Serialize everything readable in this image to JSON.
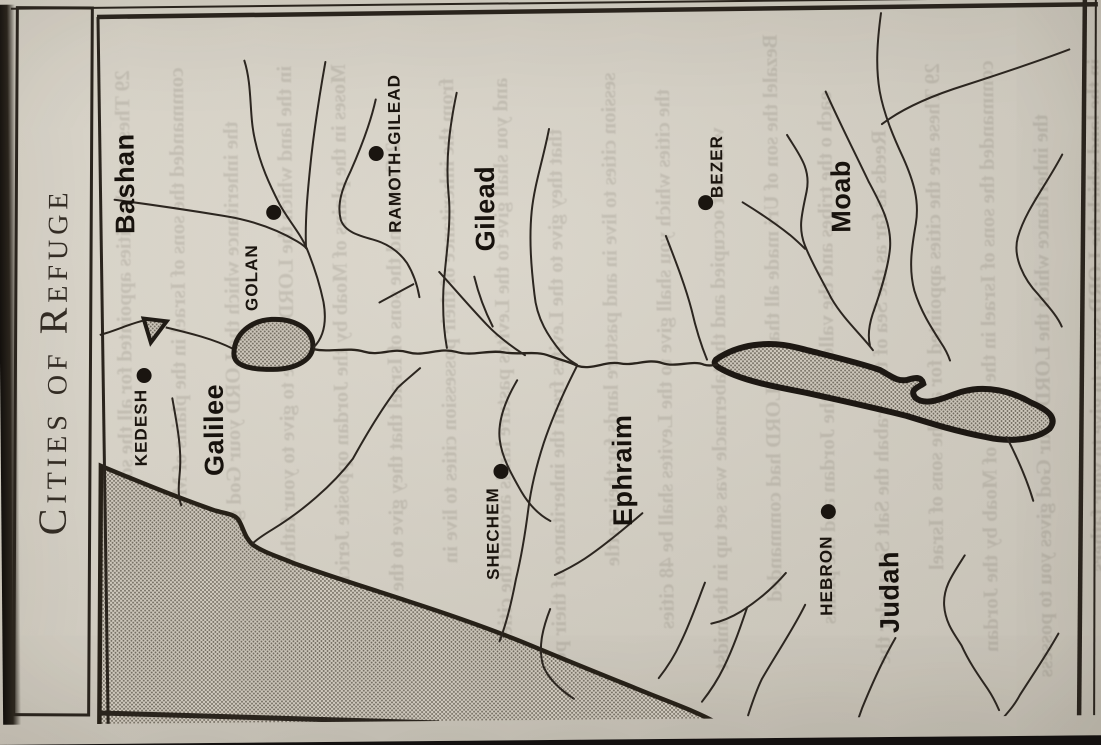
{
  "page": {
    "title": "Cities of Refuge"
  },
  "map": {
    "regions": [
      "Bashan",
      "Galilee",
      "Gilead",
      "Ephraim",
      "Moab",
      "Judah"
    ],
    "cities": [
      "KEDESH",
      "GOLAN",
      "RAMOTH-GILEAD",
      "SHECHEM",
      "BEZER",
      "HEBRON"
    ]
  },
  "colors": {
    "paper": "#d7d2c6",
    "ink": "#2a241d",
    "sea_stipple_dot": "#6f695d",
    "sea_stipple_bg": "#cfc9bd",
    "page_edge": "#17130f"
  },
  "bleed_lines": [
    "29 These are the cities appointed for all the sons of Israel",
    "commanded the sons of Israel in the plains of Moab by the Jordan",
    "the inheritance which the LORD your God gives you to possess",
    "in the land which the LORD swore to give to your fathers",
    "Moses in the plains of Moab by the Jordan opposite Jericho saying",
    "2 Command the sons of Israel that they give to the Levites",
    "from the inheritance of their possession cities to live in",
    "and you shall give to the Levites pasture lands around the cities",
    "that they give to the Levites from the inheritance of their pos",
    "session cities to live in and pasture lands for their cattle",
    "the cities which you shall give to the Levites shall be 48 cities",
    "were not occupied and the tabernacle was set up in the midst",
    "Bezalel the son of Uri made all that the LORD had commanded",
    "each o the tribes and the valley of the Jordan and the plains",
    "Reeds as far as the Sea of the Arabah the Salt Sea under the"
  ]
}
